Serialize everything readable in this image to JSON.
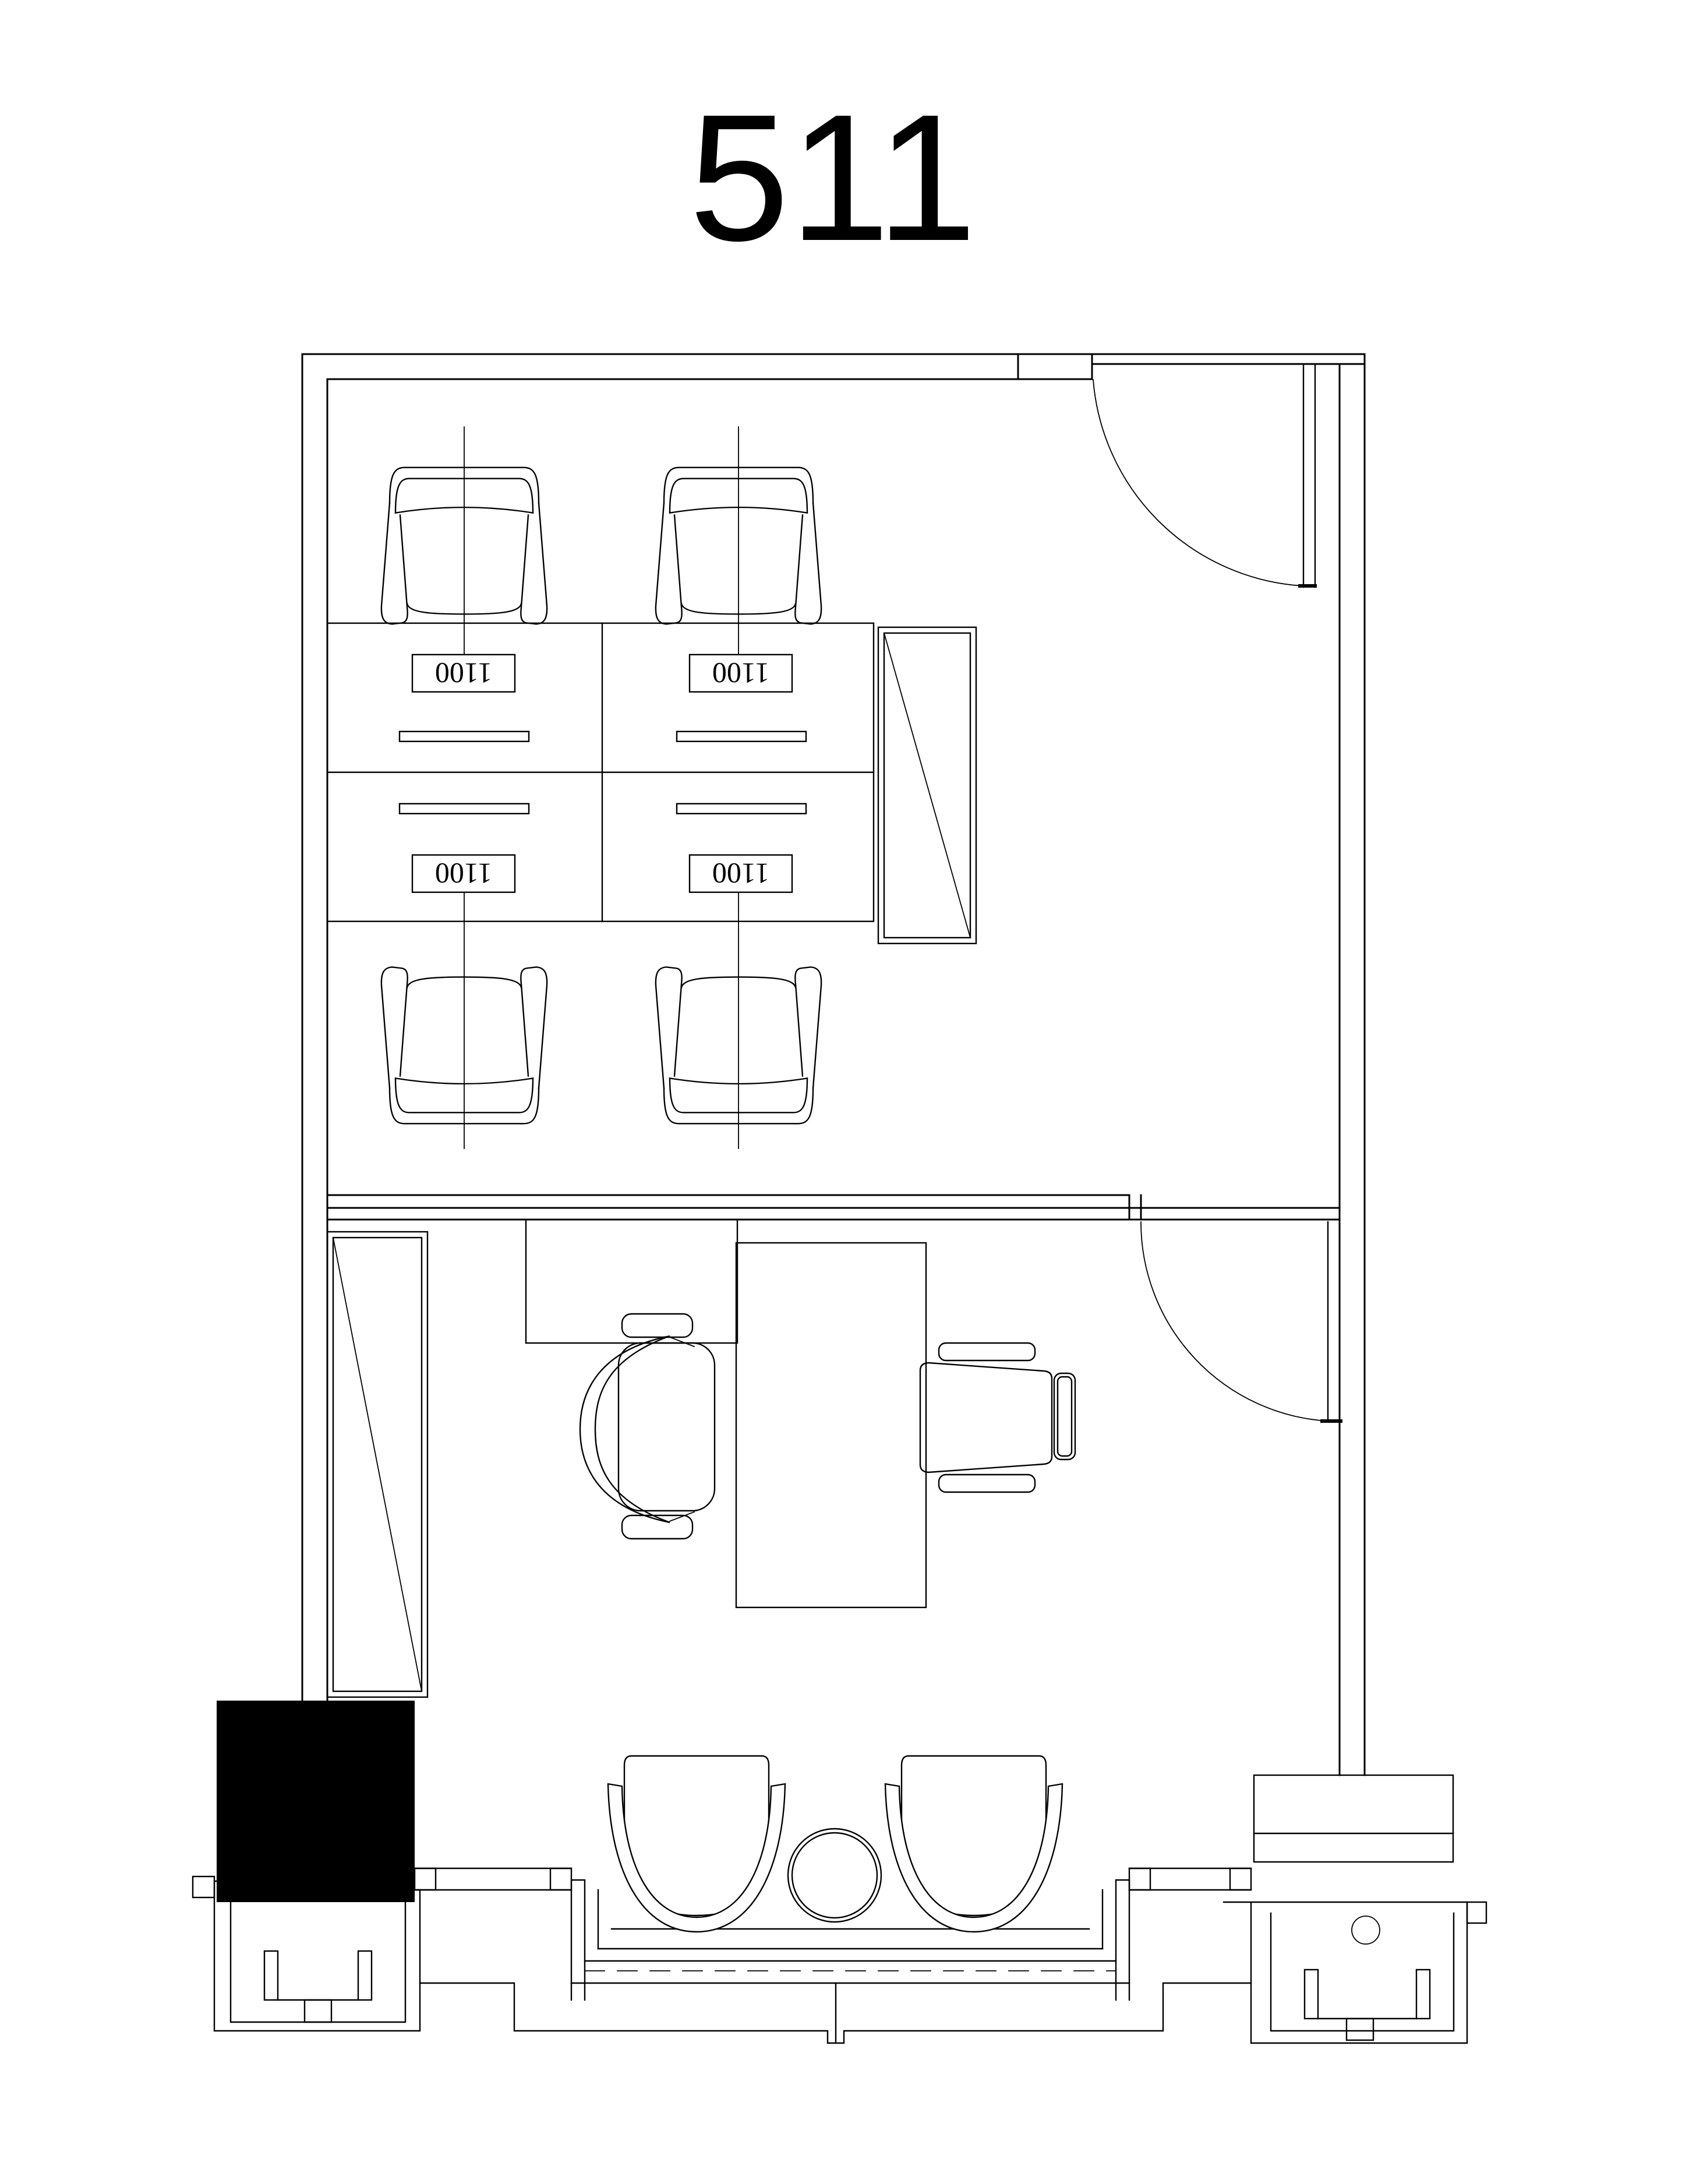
{
  "title": "511",
  "desk_labels": [
    "1100",
    "1100",
    "1100",
    "1100"
  ],
  "colors": {
    "line": "#000000",
    "paper": "#ffffff",
    "solid": "#000000"
  }
}
